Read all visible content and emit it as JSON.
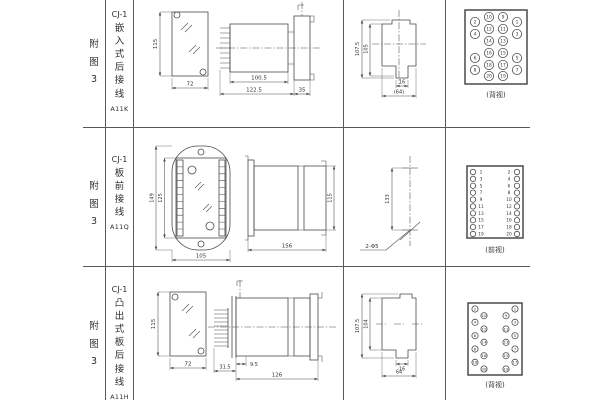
{
  "colors": {
    "background": "#ffffff",
    "grid_line": "#58595b",
    "ink": "#333333"
  },
  "table": {
    "row1": {
      "fig": "附\n图\n3",
      "model": "CJ-1",
      "type": "嵌\n入\n式\n后\n接\n线",
      "code": "A11K",
      "front": {
        "h": "115",
        "w": "72"
      },
      "side": {
        "a": "100.5",
        "b": "122.5",
        "c": "35"
      },
      "cutout": {
        "h1": "107.5",
        "h2": "105",
        "w1": "16",
        "w2": "(64)"
      },
      "caption": "(背视)"
    },
    "row2": {
      "fig": "附\n图\n3",
      "model": "CJ-1",
      "type": "板\n前\n接\n线",
      "code": "A11Q",
      "front": {
        "h1": "149",
        "h2": "125",
        "w": "105"
      },
      "side": {
        "len": "156",
        "h": "115"
      },
      "holes": {
        "dist": "133",
        "label": "2-Φ5"
      },
      "caption": "(前视)"
    },
    "row3": {
      "fig": "附\n图\n3",
      "model": "CJ-1",
      "type": "凸\n出\n式\n板\n后\n接\n线",
      "code": "A11H",
      "front": {
        "h": "115",
        "w": "72"
      },
      "side": {
        "a": "9.5",
        "b": "31.5",
        "c": "126"
      },
      "cutout": {
        "h1": "107.5",
        "h2": "104",
        "w1": "16",
        "w2": "64"
      },
      "caption": "(背视)"
    }
  },
  "terminals": {
    "back1": {
      "r": 4.6,
      "font": 4.4,
      "items": [
        {
          "n": "2",
          "x": 20,
          "y": 16
        },
        {
          "n": "10",
          "x": 34,
          "y": 11
        },
        {
          "n": "9",
          "x": 48,
          "y": 11
        },
        {
          "n": "1",
          "x": 62,
          "y": 16
        },
        {
          "n": "4",
          "x": 20,
          "y": 28
        },
        {
          "n": "12",
          "x": 34,
          "y": 23
        },
        {
          "n": "11",
          "x": 48,
          "y": 23
        },
        {
          "n": "3",
          "x": 62,
          "y": 28
        },
        {
          "n": "14",
          "x": 34,
          "y": 35
        },
        {
          "n": "13",
          "x": 48,
          "y": 35
        },
        {
          "n": "6",
          "x": 20,
          "y": 52
        },
        {
          "n": "16",
          "x": 34,
          "y": 47
        },
        {
          "n": "15",
          "x": 48,
          "y": 47
        },
        {
          "n": "5",
          "x": 62,
          "y": 52
        },
        {
          "n": "8",
          "x": 20,
          "y": 64
        },
        {
          "n": "18",
          "x": 34,
          "y": 59
        },
        {
          "n": "17",
          "x": 48,
          "y": 59
        },
        {
          "n": "7",
          "x": 62,
          "y": 64
        },
        {
          "n": "20",
          "x": 34,
          "y": 70
        },
        {
          "n": "19",
          "x": 48,
          "y": 70
        }
      ]
    },
    "front2": {
      "r": 2.7,
      "font": 4.3,
      "items": [
        {
          "n": "1",
          "x": 18,
          "y": 34,
          "tx": 26
        },
        {
          "n": "2",
          "x": 62,
          "y": 34,
          "tx": 54
        },
        {
          "n": "3",
          "x": 18,
          "y": 40.9,
          "tx": 26
        },
        {
          "n": "4",
          "x": 62,
          "y": 40.9,
          "tx": 54
        },
        {
          "n": "5",
          "x": 18,
          "y": 47.8,
          "tx": 26
        },
        {
          "n": "6",
          "x": 62,
          "y": 47.8,
          "tx": 54
        },
        {
          "n": "7",
          "x": 18,
          "y": 54.7,
          "tx": 26
        },
        {
          "n": "8",
          "x": 62,
          "y": 54.7,
          "tx": 54
        },
        {
          "n": "9",
          "x": 18,
          "y": 61.6,
          "tx": 26
        },
        {
          "n": "10",
          "x": 62,
          "y": 61.6,
          "tx": 54
        },
        {
          "n": "11",
          "x": 18,
          "y": 68.4,
          "tx": 26
        },
        {
          "n": "12",
          "x": 62,
          "y": 68.4,
          "tx": 54
        },
        {
          "n": "13",
          "x": 18,
          "y": 75.3,
          "tx": 26
        },
        {
          "n": "14",
          "x": 62,
          "y": 75.3,
          "tx": 54
        },
        {
          "n": "15",
          "x": 18,
          "y": 82.2,
          "tx": 26
        },
        {
          "n": "16",
          "x": 62,
          "y": 82.2,
          "tx": 54
        },
        {
          "n": "17",
          "x": 18,
          "y": 89.1,
          "tx": 26
        },
        {
          "n": "18",
          "x": 62,
          "y": 89.1,
          "tx": 54
        },
        {
          "n": "19",
          "x": 18,
          "y": 96,
          "tx": 26
        },
        {
          "n": "20",
          "x": 62,
          "y": 96,
          "tx": 54
        }
      ]
    },
    "back3": {
      "r": 3.1,
      "font": 3.9,
      "items": [
        {
          "n": "2",
          "x": 20,
          "y": 31
        },
        {
          "n": "10",
          "x": 29,
          "y": 37.7
        },
        {
          "n": "4",
          "x": 20,
          "y": 44.3
        },
        {
          "n": "12",
          "x": 29,
          "y": 51
        },
        {
          "n": "6",
          "x": 20,
          "y": 57.7
        },
        {
          "n": "14",
          "x": 29,
          "y": 64.3
        },
        {
          "n": "8",
          "x": 20,
          "y": 71
        },
        {
          "n": "16",
          "x": 29,
          "y": 77.7
        },
        {
          "n": "18",
          "x": 20,
          "y": 84.3
        },
        {
          "n": "20",
          "x": 29,
          "y": 91
        },
        {
          "n": "1",
          "x": 60,
          "y": 31
        },
        {
          "n": "9",
          "x": 51,
          "y": 37.7
        },
        {
          "n": "3",
          "x": 60,
          "y": 44.3
        },
        {
          "n": "11",
          "x": 51,
          "y": 51
        },
        {
          "n": "5",
          "x": 60,
          "y": 57.7
        },
        {
          "n": "13",
          "x": 51,
          "y": 64.3
        },
        {
          "n": "7",
          "x": 60,
          "y": 71
        },
        {
          "n": "15",
          "x": 51,
          "y": 77.7
        },
        {
          "n": "17",
          "x": 60,
          "y": 84.3
        },
        {
          "n": "19",
          "x": 51,
          "y": 91
        }
      ]
    }
  }
}
